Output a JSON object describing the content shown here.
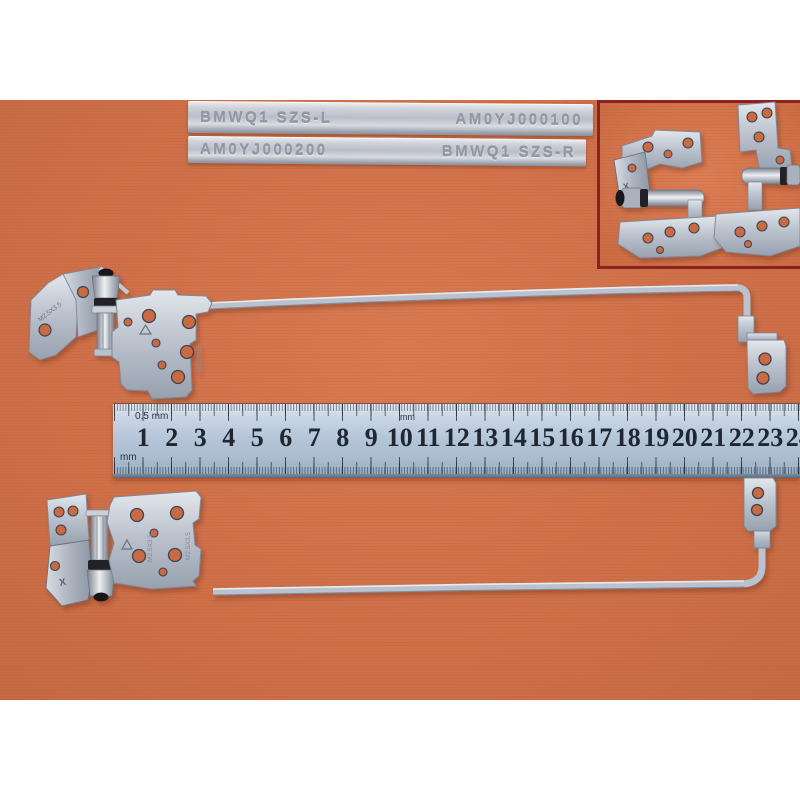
{
  "photo": {
    "bars": {
      "bar1_left": "BMWQ1 SZS-L",
      "bar1_right": "AM0YJ000100",
      "bar2_left": "AM0YJ000200",
      "bar2_right": "BMWQ1 SZS-R"
    },
    "ruler": {
      "label_half_mm": "0.5 mm",
      "label_mm_left": "mm",
      "label_mm_mid": "mm",
      "numbers": [
        "1",
        "2",
        "3",
        "4",
        "5",
        "6",
        "7",
        "8",
        "9",
        "10",
        "11",
        "12",
        "13",
        "14",
        "15",
        "16",
        "17",
        "18",
        "19",
        "20",
        "21",
        "22",
        "23",
        "24"
      ]
    },
    "hinges": {
      "stamp_size": "M2.5X3.5",
      "stamp_mark": "X"
    },
    "colors": {
      "background_orange": "#cf7049",
      "ruler_blue": "#b3c4d7",
      "metal_silver": "#bfc5cf",
      "inset_border": "#8b2222",
      "ruler_number_ink": "#1e2733"
    }
  }
}
